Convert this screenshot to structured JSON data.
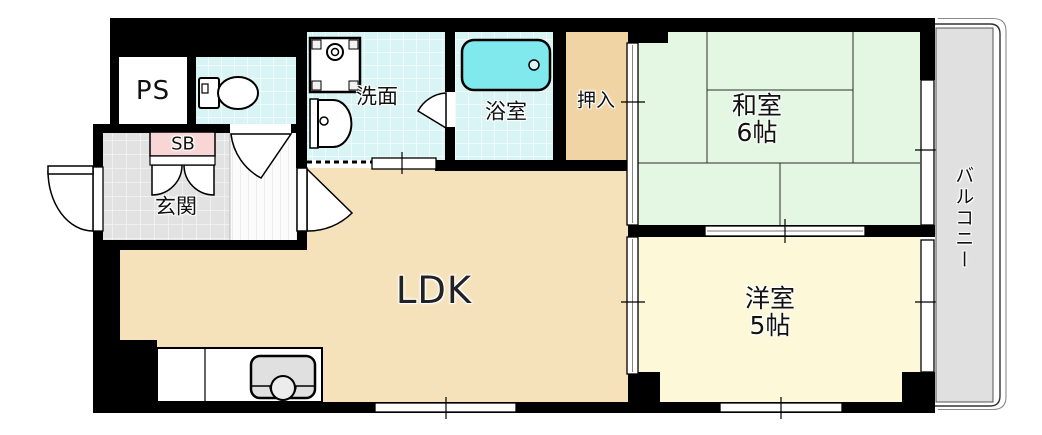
{
  "plan": {
    "type": "apartment-floor-plan",
    "rooms": {
      "ldk": {
        "label": "LDK"
      },
      "washitsu": {
        "label": "和室",
        "size": "6帖"
      },
      "yoshitsu": {
        "label": "洋室",
        "size": "5帖"
      },
      "yokushitsu": {
        "label": "浴室"
      },
      "senmen": {
        "label": "洗面"
      },
      "oshiire": {
        "label": "押入"
      },
      "genkan": {
        "label": "玄関"
      },
      "ps": {
        "label": "PS"
      },
      "sb": {
        "label": "SB"
      },
      "balcony": {
        "label": "バルコニー"
      }
    },
    "fixtures": [
      "toilet-icon",
      "washing-machine-icon",
      "vanity-sink-icon",
      "bathtub-icon",
      "kitchen-sink-icon"
    ],
    "colors": {
      "wall": "#000000",
      "ldk_floor": "#f5e2bb",
      "tatami_floor": "#e3f7e3",
      "western_floor": "#fdf8d8",
      "wet_area_tile": "#d9f4f4",
      "bathtub": "#7fe9ed",
      "closet_floor": "#f0d4a4",
      "balcony_floor": "#e0e0e0",
      "genkan_tile": "#e2e2e2",
      "shoebox": "#f8d6d6"
    }
  }
}
